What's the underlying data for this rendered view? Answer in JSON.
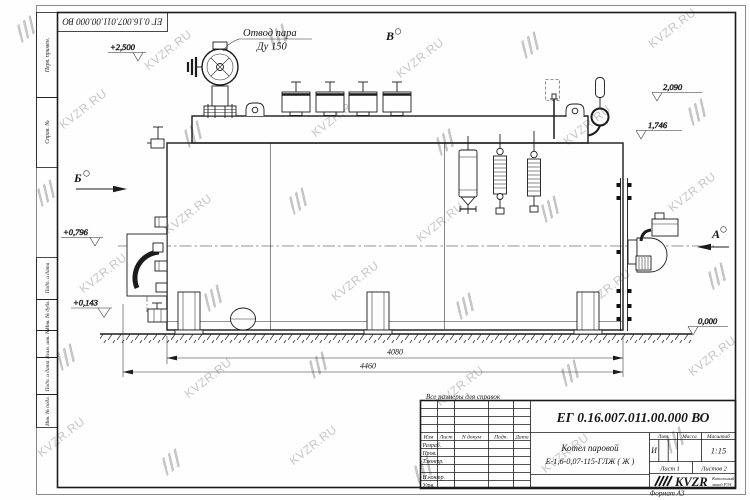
{
  "watermark": {
    "text": "KVZR.RU"
  },
  "sheet": {
    "stamp_top": "ЕГ 0.16.007.011.00.000  ВО",
    "format_note": "Формат А3",
    "left_strip": [
      {
        "label": "Перв. примен."
      },
      {
        "label": "Справ. №"
      },
      {
        "label": "Подп. и дата"
      },
      {
        "label": "Инв. № дубл."
      },
      {
        "label": "Взам. инв. №"
      },
      {
        "label": "Подп. и дата"
      },
      {
        "label": "Инв. № подл."
      }
    ]
  },
  "drawing": {
    "note": "Все размеры для справок",
    "callout": {
      "line1": "Отвод пара",
      "line2": "Ду 150"
    },
    "views": {
      "b": "Б",
      "v": "В",
      "a": "А"
    },
    "elevations": {
      "e2500": "+2,500",
      "e2090": "2,090",
      "e1746": "1,746",
      "e0796": "+0,796",
      "e0143": "+0,143",
      "e0000": "0,000"
    },
    "dims": {
      "d4080": "4080",
      "d4460": "4460"
    }
  },
  "title_block": {
    "doc_number": "ЕГ 0.16.007.011.00.000  ВО",
    "name_line1": "Котел паровой",
    "name_line2": "Е-1,6-0,07-115-ГЛЖ ( Ж )",
    "header": {
      "izm": "Изм",
      "list": "Лист",
      "ndocum": "N докум",
      "podp": "Подп.",
      "data": "Дата"
    },
    "rows": {
      "razrab": "Разраб.",
      "prov": "Пров.",
      "tkontr": "Т.контр.",
      "nkontr": "Н.контр.",
      "utv": "Утв."
    },
    "lit_label": "Лит.",
    "mass_label": "Масса",
    "scale_label": "Масштаб",
    "lit_value": "И",
    "scale_value": "1:15",
    "sheet_info": {
      "list": "Лист 1",
      "listov": "Листов 2"
    },
    "company": {
      "logo": "KVZR",
      "line1": "Котельный",
      "line2": "завод РЭ1"
    }
  }
}
